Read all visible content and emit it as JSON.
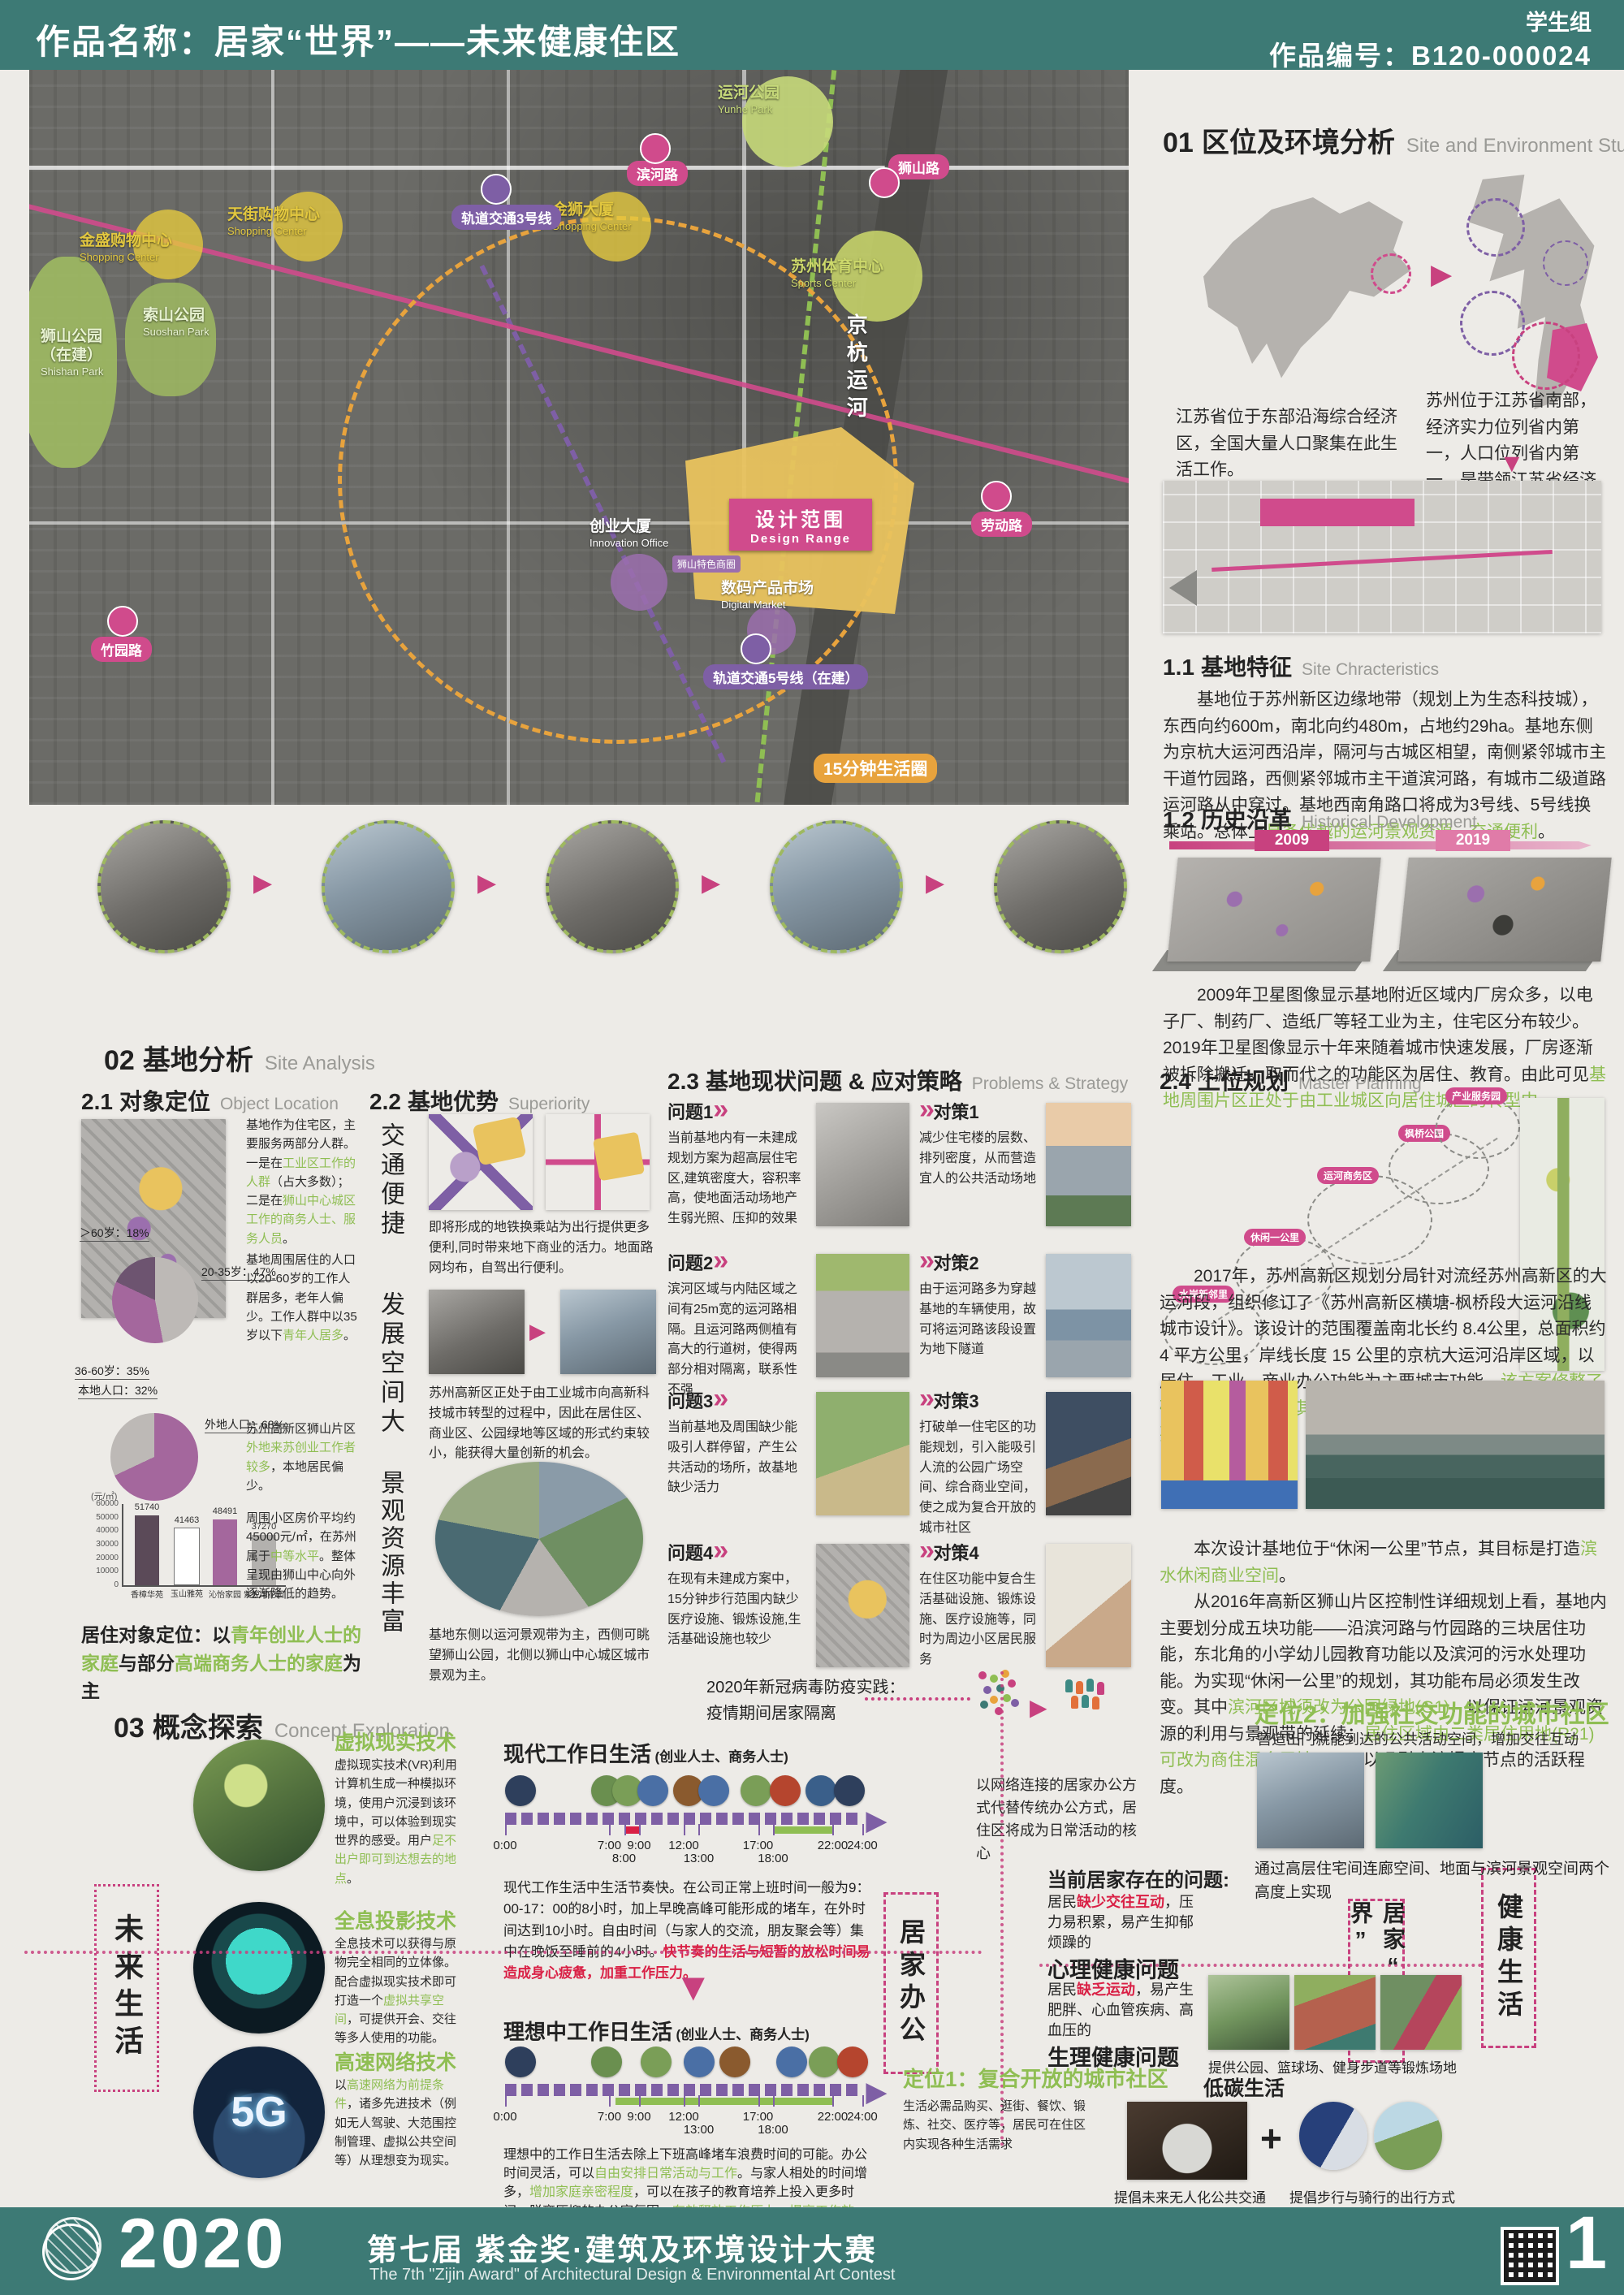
{
  "header": {
    "title": "作品名称：居家“世界”——未来健康住区",
    "group": "学生组",
    "number": "作品编号：B120-000024"
  },
  "map": {
    "yunhe": "运河公园",
    "yunhe_en": "Yunhe Park",
    "jinsheng": "金盛购物中心",
    "jinsheng_en": "Shopping Center",
    "tianjie": "天街购物中心",
    "tianjie_en": "Shopping Center",
    "jinshi": "金狮大厦",
    "jinshi_en": "Shopping Center",
    "sports": "苏州体育中心",
    "sports_en": "Sports Center",
    "shishan": "狮山公园（在建）",
    "shishan_en": "Shishan Park",
    "suoshan": "索山公园",
    "suoshan_en": "Suoshan Park",
    "binhe": "滨河路",
    "shishanlu": "狮山路",
    "laodong": "劳动路",
    "zhuyuan": "竹园路",
    "metro3": "轨道交通3号线",
    "metro5": "轨道交通5号线（在建）",
    "canal": "京杭运河",
    "design": "设计范围",
    "design_en": "Design Range",
    "innovation": "创业大厦",
    "innovation_en": "Innovation Office",
    "digital": "数码产品市场",
    "digital_en": "Digital Market",
    "shangquan": "狮山特色商圈",
    "circle15": "15分钟生活圈"
  },
  "s01": {
    "no": "01",
    "zh": "区位及环境分析",
    "en": "Site and Environment Study",
    "cap_l": "江苏省位于东部沿海综合经济区，全国大量人口聚集在此生活工作。",
    "cap_r": "苏州位于江苏省南部，经济实力位列省内第一，人口位列省内第一，是带领江苏省经济发展的重要城市",
    "s11": {
      "no": "1.1",
      "zh": "基地特征",
      "en": "Site Chracteristics",
      "t": "基地位于苏州新区边缘地带（规划上为生态科技城），东西向约600m，南北向约480m，占地约29ha。基地东侧为京杭大运河西沿岸，隔河与古城区相望，南侧紧邻城市主干道竹园路，西侧紧邻城市主干道滨河路，有城市二级道路运河路从中穿过。基地西南角路口将成为3号线、5号线换乘站。总体上",
      "g": "具备优越的运河景观资源，交通便利",
      "end": "。"
    },
    "s12": {
      "no": "1.2",
      "zh": "历史沿革",
      "en": "Historical Development",
      "y1": "2009",
      "y2": "2019",
      "t": "2009年卫星图像显示基地附近区域内厂房众多，以电子厂、制药厂、造纸厂等轻工业为主，住宅区分布较少。2019年卫星图像显示十年来随着城市快速发展，厂房逐渐被拆除搬迁。取而代之的功能区为居住、教育。由此可见",
      "g": "基地周围片区正处于由工业城区向居住城区的转型中",
      "end": "。"
    }
  },
  "s02": {
    "no": "02",
    "zh": "基地分析",
    "en": "Site Analysis",
    "s21": {
      "no": "2.1",
      "zh": "对象定位",
      "en": "Object Location",
      "t1a": "基地作为住宅区，主要服务两部分人群。一是在",
      "t1g1": "工业区工作的人群",
      "t1b": "（占大多数）；二是在",
      "t1g2": "狮山中心城区工作的商务人士、服务人员",
      "t1c": "。",
      "pie1_l1": "＞60岁：18%",
      "pie1_l2": "20-35岁：47%",
      "pie1_l3": "36-60岁：35%",
      "t2a": "基地周围居住的人口以20-60岁的工作人群居多，老年人偏少。工作人群中以35岁以下",
      "t2g": "青年人居多",
      "t2c": "。",
      "pie2_l1": "本地人口：32%",
      "pie2_l2": "外地人口：68%",
      "t3a": "苏州高新区狮山片区",
      "t3g": "外地来苏创业工作者较多",
      "t3c": "，本地居民偏少。",
      "t4a": "周围小区房价平均约45000元/㎡，在苏州属于",
      "t4g": "中等水平",
      "t4c": "。整体呈现由狮山中心向外逐渐降低的趋势。",
      "posa": "居住对象定位：以",
      "posg1": "青年创业人士的家庭",
      "posb": "与部分",
      "posg2": "高端商务人士的家庭",
      "posc": "为主"
    },
    "s22": {
      "no": "2.2",
      "zh": "基地优势",
      "en": "Superiority",
      "v1": "交通便捷",
      "p1": "即将形成的地铁换乘站为出行提供更多便利,同时带来地下商业的活力。地面路网均布，自驾出行便利。",
      "v2": "发展空间大",
      "p2": "苏州高新区正处于由工业城市向高新科技城市转型的过程中，因此在居住区、商业区、公园绿地等区域的形式约束较小，能获得大量创新的机会。",
      "v3": "景观资源丰富",
      "p3": "基地东侧以运河景观带为主，西侧可眺望狮山公园，北侧以狮山中心城区城市景观为主。"
    },
    "s23": {
      "no": "2.3",
      "zh": "基地现状问题 & 应对策略",
      "en": "Problems & Strategy",
      "rows": [
        {
          "q": "问题1",
          "qt": "当前基地内有一未建成规划方案为超高层住宅区,建筑密度大，容积率高，使地面活动场地产生弱光照、压抑的效果",
          "s": "对策1",
          "st": "减少住宅楼的层数、排列密度，从而营造宜人的公共活动场地"
        },
        {
          "q": "问题2",
          "qt": "滨河区域与内陆区域之间有25m宽的运河路相隔。且运河路两侧植有高大的行道树，使得两部分相对隔离，联系性不强",
          "s": "对策2",
          "st": "由于运河路多为穿越基地的车辆使用，故可将运河路该段设置为地下隧道"
        },
        {
          "q": "问题3",
          "qt": "当前基地及周围缺少能吸引人群停留，产生公共活动的场所，故基地缺少活力",
          "s": "对策3",
          "st": "打破单一住宅区的功能规划，引入能吸引人流的公园广场空间、综合商业空间，使之成为复合开放的城市社区"
        },
        {
          "q": "问题4",
          "qt": "在现有未建成方案中，15分钟步行范围内缺少医疗设施、锻炼设施,生活基础设施也较少",
          "s": "对策4",
          "st": "在住区功能中复合生活基础设施、锻炼设施、医疗设施等，同时为周边小区居民服务"
        }
      ],
      "covid1": "2020年新冠病毒防疫实践：",
      "covid2": "疫情期间居家隔离"
    },
    "s24": {
      "no": "2.4",
      "zh": "上位规划",
      "en": "Master Planning",
      "nodes": [
        "水岸新邻里",
        "休闲一公里",
        "运河商务区",
        "枫桥公园",
        "产业服务园"
      ],
      "p1a": "2017年，苏州高新区规划分局针对流经苏州高新区的大运河段，组织修订了《苏州高新区横塘-枫桥段大运河沿线城市设计》。该设计的范围覆盖南北长约 8.4公里，总面积约 4 平方公里，岸线长度 15 公里的京杭大运河沿岸区域，以居住、工业、商业办公功能为主要城市功能。",
      "p1g": "该方案修整了破碎的运河岸，使其形成完整的滨河景观带，并设置5个重要的节点。",
      "p2a": "本次设计基地位于“休闲一公里”节点，其目标是打造",
      "p2g": "滨水休闲商业空间",
      "p2c": "。",
      "p3a": "从2016年高新区狮山片区控制性详细规划上看，基地内主要划分成五块功能——沿滨河路与竹园路的三块居住功能，东北角的小学幼儿园教育功能以及滨河的污水处理功能。为实现“休闲一公里”的规划，其功能布局必须发生改变。其中",
      "p3g1": "滨河区域须改为公园绿地(G1)",
      "p3b": "，以保证运河景观资源的利用与景观带的延续；",
      "p3g2": "居住区域由二类居住用地(R21)可改为商住混合用地(Rb)",
      "p3c": "，以吸引人流提高节点的活跃程度。"
    }
  },
  "s03": {
    "no": "03",
    "zh": "概念探索",
    "en": "Concept Exploration",
    "future": "未来生活",
    "vr": {
      "h": "虚拟现实技术",
      "a": "虚拟现实技术(VR)利用计算机生成一种模拟环境，使用户沉浸到该环境中，可以体验到现实世界的感受。用户",
      "g": "足不出户即可到达想去的地点",
      "c": "。"
    },
    "holo": {
      "h": "全息投影技术",
      "a": "全息技术可以获得与原物完全相同的立体像。配合虚拟现实技术即可打造一个",
      "g": "虚拟共享空间",
      "c": "，可提供开会、交往等多人使用的功能。"
    },
    "net": {
      "h": "高速网络技术",
      "a": "以",
      "g": "高速网络为前提条件",
      "c": "，诸多先进技术（例如无人驾驶、大范围控制管理、虚拟公共空间等）从理想变为现实。",
      "badge": "5G"
    },
    "t1h": "现代工作日生活",
    "t1sub": "(创业人士、商务人士)",
    "t2h": "理想中工作日生活",
    "t2sub": "(创业人士、商务人士)",
    "ticks": [
      "0:00",
      "7:00",
      "8:00",
      "9:00",
      "12:00",
      "13:00",
      "17:00",
      "18:00",
      "22:00",
      "24:00"
    ],
    "t1pa": "现代工作生活中生活节奏快。在公司正常上班时间一般为9：00-17：00的8小时，加上早晚高峰可能形成的堵车，在外时间达到10小时。自由时间（与家人的交流，朋友聚会等）集中在晚饭至睡前的4小时。",
    "t1pr": "快节奏的生活与短暂的放松时间易造成身心疲惫，加重工作压力。",
    "t2pa": "理想中的工作日生活去除上下班高峰堵车浪费时间的可能。办公时间灵活，可以",
    "t2g1": "自由安排日常活动与工作",
    "t2pb": "。与家人相处的时间增多，",
    "t2g2": "增加家庭亲密程度",
    "t2pc": "，可以在孩子的教育培养上投入更多时间。脱离压抑的办公室氛围，",
    "t2g3": "有效释放工作压力，提高工作效率",
    "t2pd": "。",
    "home_office": "居家办公",
    "home_world1": "居家",
    "home_world2": "“世界”",
    "healthy": "健康生活",
    "network": "以网络连接的居家办公方式代替传统办公方式，居住区将成为日常活动的核心",
    "pos2h": "定位2：加强社交功能的城市社区",
    "pos2sub": "营造出门就能到达的公共活动空间，增加交往互动",
    "pos2cap": "通过高层住宅间连廊空间、地面与滨河景观空间两个高度上实现",
    "probh": "当前居家存在的问题:",
    "ma": "居民",
    "mr": "缺少交往互动",
    "mb": "，压力易积累，易产生抑郁烦躁的",
    "mbold": "心理健康问题",
    "pa": "居民",
    "pr": "缺乏运动",
    "pb": "，易产生肥胖、心血管疾病、高血压的",
    "pbold": "生理健康问题",
    "probcap": "提供公园、篮球场、健身步道等锻炼场地",
    "pos1h": "定位1：复合开放的城市社区",
    "pos1sub": "生活必需品购买、逛街、餐饮、锻炼、社交、医疗等，居民可在住区内实现各种生活需求",
    "low_carbon": "低碳生活",
    "bus_cap": "提倡未来无人化公共交通",
    "plus": "+",
    "walk_cap": "提倡步行与骑行的出行方式"
  },
  "footer": {
    "year": "2020",
    "zh": "第七届 紫金奖·建筑及环境设计大赛",
    "en": "The 7th \"Zijin Award\" of Architectural Design & Environmental Art Contest",
    "page": "1"
  },
  "chart_data": [
    {
      "type": "pie",
      "labels": [
        "20-35岁",
        "36-60岁",
        ">60岁"
      ],
      "values": [
        47,
        35,
        18
      ],
      "colors": [
        "#bdb9b6",
        "#a4679d",
        "#6d5470"
      ],
      "legend_position": "callout"
    },
    {
      "type": "pie",
      "labels": [
        "外地人口",
        "本地人口"
      ],
      "values": [
        68,
        32
      ],
      "colors": [
        "#a4679d",
        "#bdb9b6"
      ],
      "legend_position": "callout"
    },
    {
      "type": "bar",
      "unit": "(元/㎡)",
      "categories": [
        "香樟华苑",
        "玉山雅苑",
        "沁怡家园",
        "紫悦湾花园"
      ],
      "values": [
        51740,
        41463,
        48491,
        37270
      ],
      "colors": [
        "#5b4a58",
        "#ffffff",
        "#a4679d",
        "#b3b1ae"
      ],
      "ylim": [
        0,
        60000
      ],
      "yticks": [
        0,
        10000,
        20000,
        30000,
        40000,
        50000,
        60000
      ],
      "grid": false
    }
  ]
}
